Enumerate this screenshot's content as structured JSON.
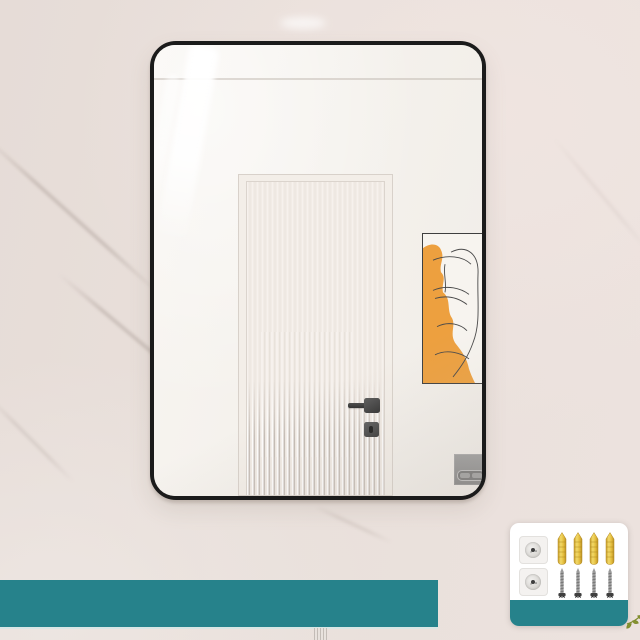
{
  "alt": "Product photo: wall-mounted rectangular mirror with thin black rounded frame on a marble wall; reflection shows a fluted-glass door with black handle and an orange abstract art print; teal banner strip at bottom left; inset card at bottom right showing mounting hardware",
  "colors": {
    "wall": "#E9E0DB",
    "wall_right": "#ECE2DE",
    "frame": "#1B1B1B",
    "glass": "#F4F1EC",
    "door": "#F2ECE6",
    "poster_orange": "#EDA03F",
    "poster_line": "#4A4A4A",
    "banner_teal": "#26828B",
    "anchor_yellow": "#E8C644",
    "card_bg": "#FFFFFF",
    "plate_gray": "#F4F2F0",
    "flush_gray": "#8F8F8F",
    "sprig_green": "#7F8C2D"
  },
  "hardware_kit": {
    "plate_count": 2,
    "anchor_count": 4,
    "screw_count": 4
  }
}
